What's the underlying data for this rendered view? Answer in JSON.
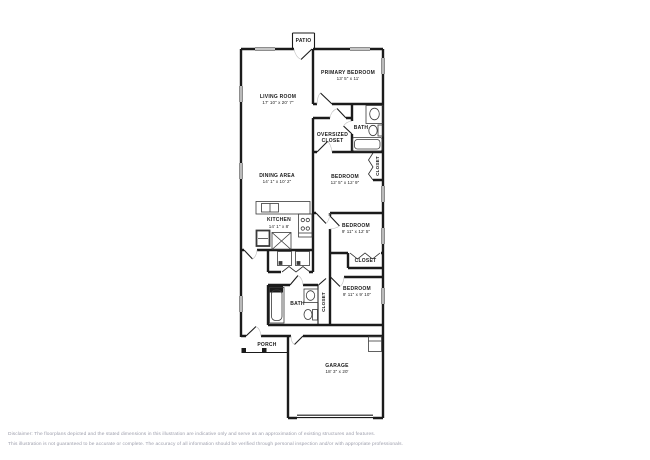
{
  "floorplan": {
    "patio": {
      "label": "PATIO"
    },
    "primary_bedroom": {
      "name": "PRIMARY BEDROOM",
      "dims": "13' 5\" x 11'"
    },
    "living_room": {
      "name": "LIVING ROOM",
      "dims": "17' 10\" x 20' 7\""
    },
    "bath_upper": {
      "label": "BATH"
    },
    "oversized_closet": {
      "name": "OVERSIZED CLOSET"
    },
    "closet_upper": {
      "label": "CLOSET"
    },
    "bedroom2": {
      "name": "BEDROOM",
      "dims": "12' 5\" x 12' 9\""
    },
    "dining_area": {
      "name": "DINING AREA",
      "dims": "14' 1\" x 10' 2\""
    },
    "kitchen": {
      "name": "KITCHEN",
      "dims": "14' 1\" x 8'"
    },
    "bedroom3": {
      "name": "BEDROOM",
      "dims": "9' 11\" x 12' 5\""
    },
    "closet_bedroom3": {
      "label": "CLOSET"
    },
    "bath_lower": {
      "label": "BATH"
    },
    "closet_lower": {
      "label": "CLOSET"
    },
    "bedroom4": {
      "name": "BEDROOM",
      "dims": "9' 11\" x 9' 10\""
    },
    "porch": {
      "label": "PORCH"
    },
    "garage": {
      "name": "GARAGE",
      "dims": "18' 3\" x 20'"
    }
  },
  "disclaimer": {
    "line1": "Disclaimer: The floorplans depicted and the stated dimensions in this illustration are indicative only and serve as an approximation of existing structures and features.",
    "line2": "This illustration is not guaranteed to be accurate or complete. The accuracy of all information should be verified through personal inspection and/or with appropriate professionals."
  },
  "colors": {
    "wall": "#1b1b1b",
    "fixture": "#3a3a3a",
    "door_arc": "#bcbcbc",
    "disclaimer_text": "#9c9dab"
  }
}
